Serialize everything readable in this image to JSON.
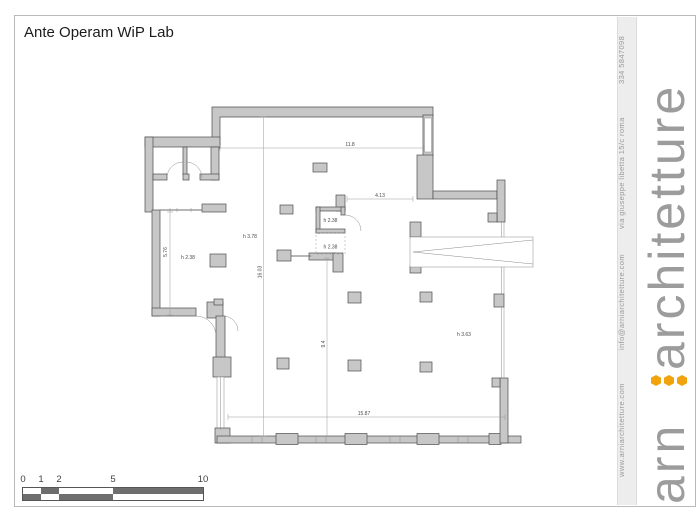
{
  "title": "Ante Operam WiP Lab",
  "plan": {
    "labels": {
      "dim_top": "11.8",
      "dim_right": "4.13",
      "dim_bottom": "15.87",
      "dim_total_height": "16.03",
      "dim_left_height": "5.76",
      "dim_inner_height": "9.4",
      "h_main_hall": "h 3.78",
      "h_left_zone": "h 2.38",
      "h_small_room": "h 2.38",
      "h_small_room_lower": "h 2.38",
      "h_right_hall": "h 3.63"
    }
  },
  "scalebar": {
    "labels": [
      "0",
      "1",
      "2",
      "5",
      "10"
    ]
  },
  "sidebar": {
    "phone": "334 5847098",
    "address": "via giuseppe libetta 15/c roma",
    "email": "info@arniarchitetture.com",
    "website": "www.arniarchitetture.com",
    "logo_prefix": "arn",
    "logo_suffix": "architetture",
    "accent_color": "#F0A30A"
  }
}
